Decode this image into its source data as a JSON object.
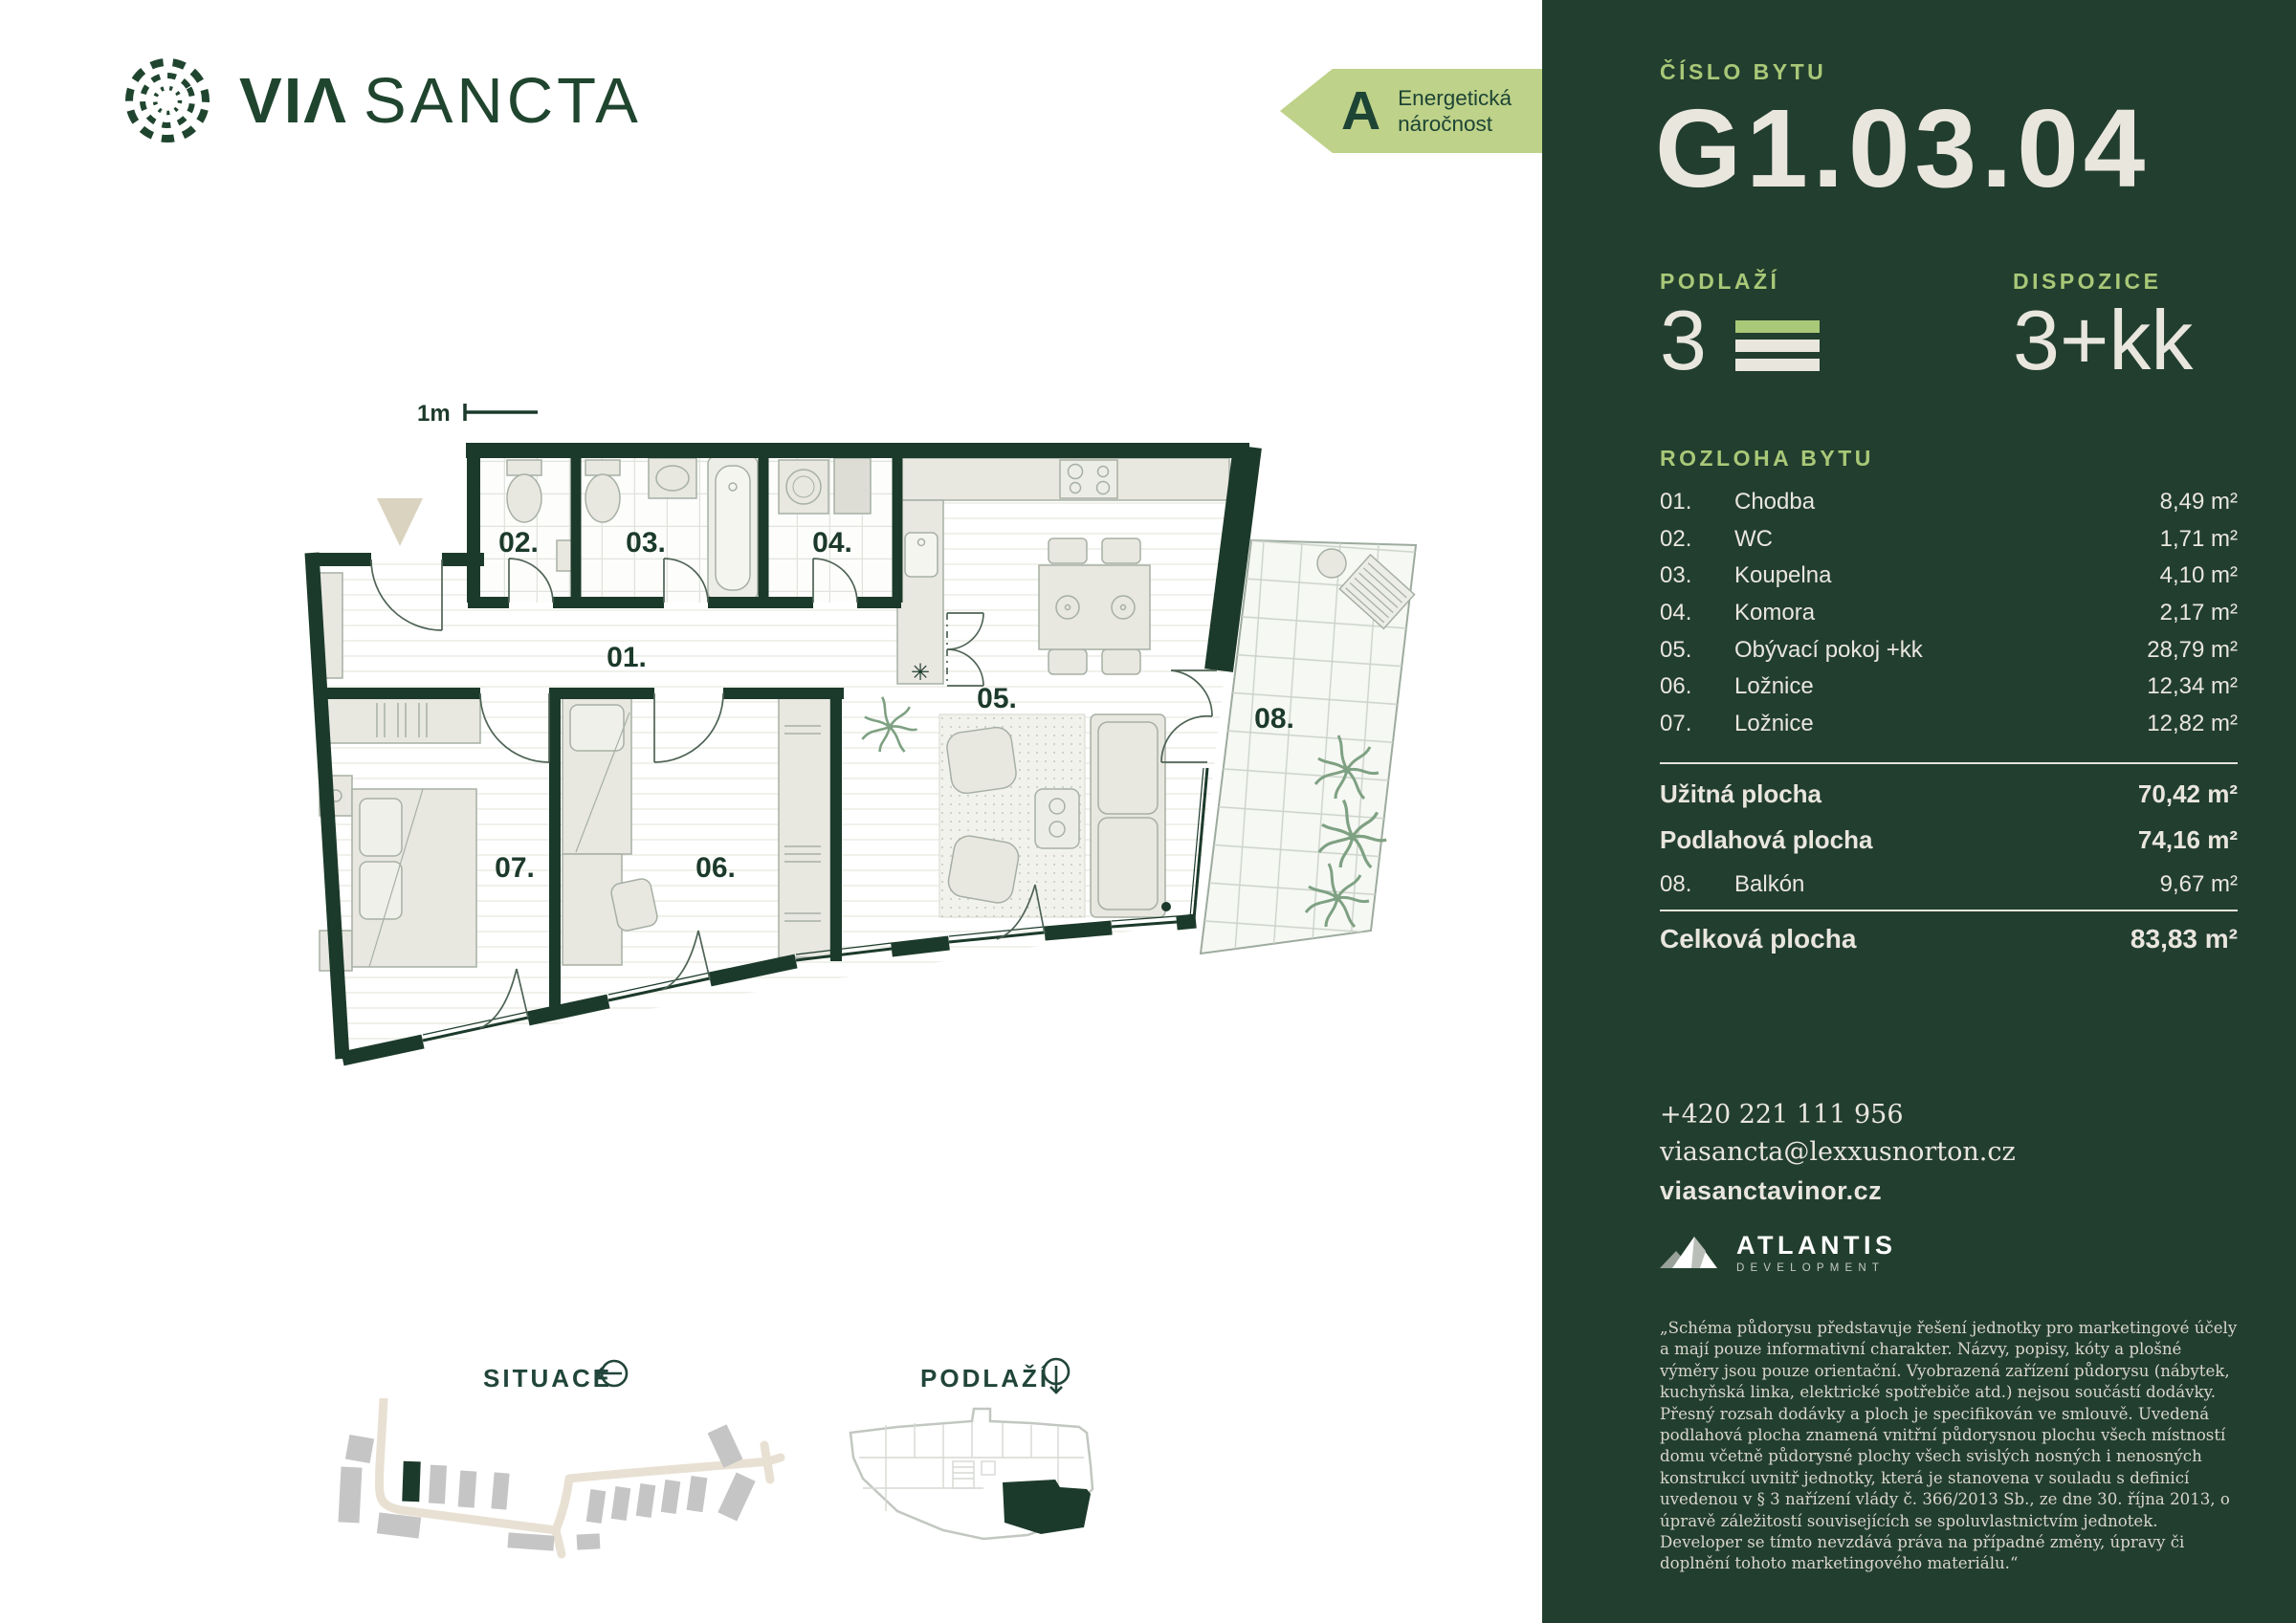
{
  "brand": {
    "word1": "VIΛ",
    "word2": "SANCTA"
  },
  "energy_badge": {
    "grade": "A",
    "line1": "Energetická",
    "line2": "náročnost"
  },
  "plan": {
    "scale_label": "1m",
    "kitchen_symbol": "✳",
    "room_labels": [
      "01.",
      "02.",
      "03.",
      "04.",
      "05.",
      "06.",
      "07.",
      "08."
    ]
  },
  "footer": {
    "situace_label": "SITUACE",
    "podlazi_label": "PODLAŽÍ"
  },
  "panel": {
    "unit_label": "ČÍSLO BYTU",
    "unit_number": "G1.03.04",
    "floor_label": "PODLAŽÍ",
    "floor_value": "3",
    "disposition_label": "DISPOZICE",
    "disposition_value": "3+kk",
    "area_label": "ROZLOHA BYTU",
    "rooms": [
      {
        "num": "01.",
        "name": "Chodba",
        "area": "8,49 m²"
      },
      {
        "num": "02.",
        "name": "WC",
        "area": "1,71 m²"
      },
      {
        "num": "03.",
        "name": "Koupelna",
        "area": "4,10 m²"
      },
      {
        "num": "04.",
        "name": "Komora",
        "area": "2,17 m²"
      },
      {
        "num": "05.",
        "name": "Obývací pokoj +kk",
        "area": "28,79 m²"
      },
      {
        "num": "06.",
        "name": "Ložnice",
        "area": "12,34 m²"
      },
      {
        "num": "07.",
        "name": "Ložnice",
        "area": "12,82 m²"
      }
    ],
    "usable": {
      "label": "Užitná plocha",
      "value": "70,42 m²"
    },
    "floor_area": {
      "label": "Podlahová plocha",
      "value": "74,16 m²"
    },
    "balcony": {
      "num": "08.",
      "name": "Balkón",
      "area": "9,67 m²"
    },
    "total": {
      "label": "Celková plocha",
      "value": "83,83 m²"
    },
    "contact": {
      "phone": "+420 221 111 956",
      "email": "viasancta@lexxusnorton.cz",
      "web": "viasanctavinor.cz"
    },
    "developer": {
      "name": "ATLANTIS",
      "sub": "DEVELOPMENT"
    },
    "disclaimer": "„Schéma půdorysu představuje řešení jednotky pro marketingové účely a mají pouze informativní charakter. Názvy, popisy, kóty a plošné výměry jsou pouze orientační. Vyobrazená zařízení půdorysu (nábytek, kuchyňská linka, elektrické spotřebiče atd.) nejsou součástí dodávky. Přesný rozsah dodávky a ploch je specifikován ve smlouvě. Uvedená podlahová plocha znamená vnitřní půdorysnou plochu všech místností domu včetně půdorysné plochy všech svislých nosných i nenosných konstrukcí uvnitř jednotky, která je stanovena v souladu s definicí uvedenou v § 3 nařízení vlády č. 366/2013 Sb., ze dne 30. října 2013, o úpravě záležitostí souvisejících se spoluvlastnictvím jednotek. Developer se tímto nevzdává práva na případné změny, úpravy či doplnění tohoto marketingového materiálu.“"
  },
  "colors": {
    "panel_green": "#223E2E",
    "wall_green": "#1C3A2B",
    "accent_green": "#A9C878",
    "badge_green": "#BED289",
    "cream": "#E9E6DE",
    "road_beige": "#E8E1D3",
    "building_gray": "#C5C5C5"
  }
}
